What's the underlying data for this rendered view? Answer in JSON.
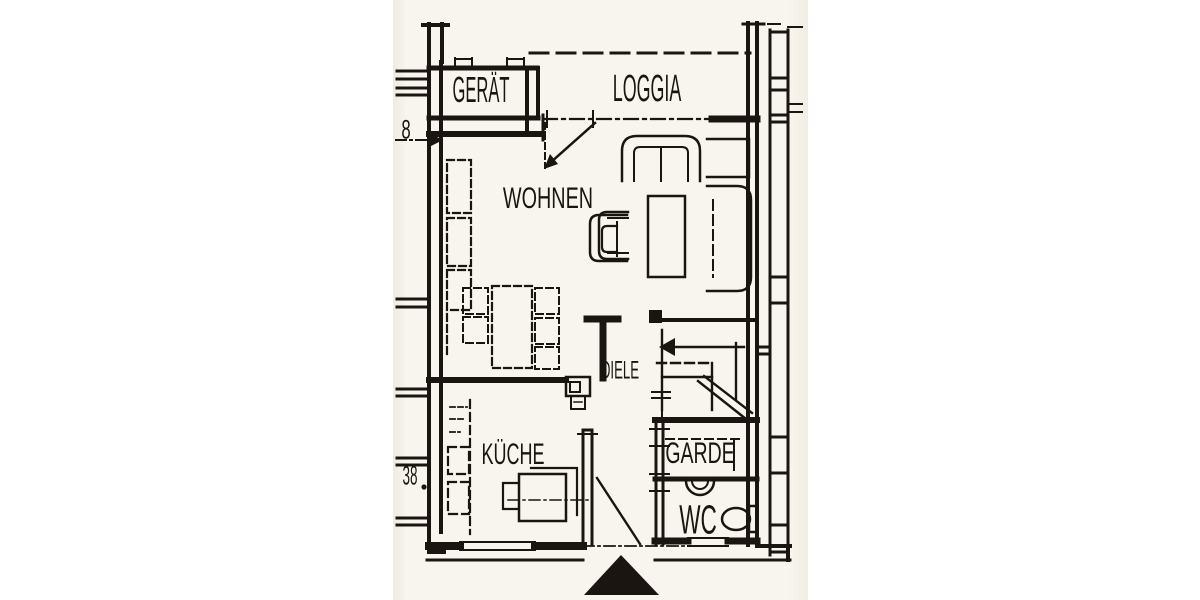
{
  "page": {
    "title": "Grundriss Wohnung (scanned floor plan)"
  },
  "rooms": {
    "geraet": "GERÄT",
    "loggia": "LOGGIA",
    "wohnen": "WOHNEN",
    "diele": "DIELE",
    "kueche": "KÜCHE",
    "garde": "GARDE",
    "wc": "WC"
  },
  "dimension_marks": {
    "upper_left": "8",
    "lower_left": "38"
  },
  "symbols": {
    "entrance_marker": "filled triangle (main entrance)",
    "stair_direction": "arrow pointing left"
  },
  "colors": {
    "ink": "#1a1511",
    "paper": "#f8f5ee",
    "canvas": "#ffffff"
  }
}
